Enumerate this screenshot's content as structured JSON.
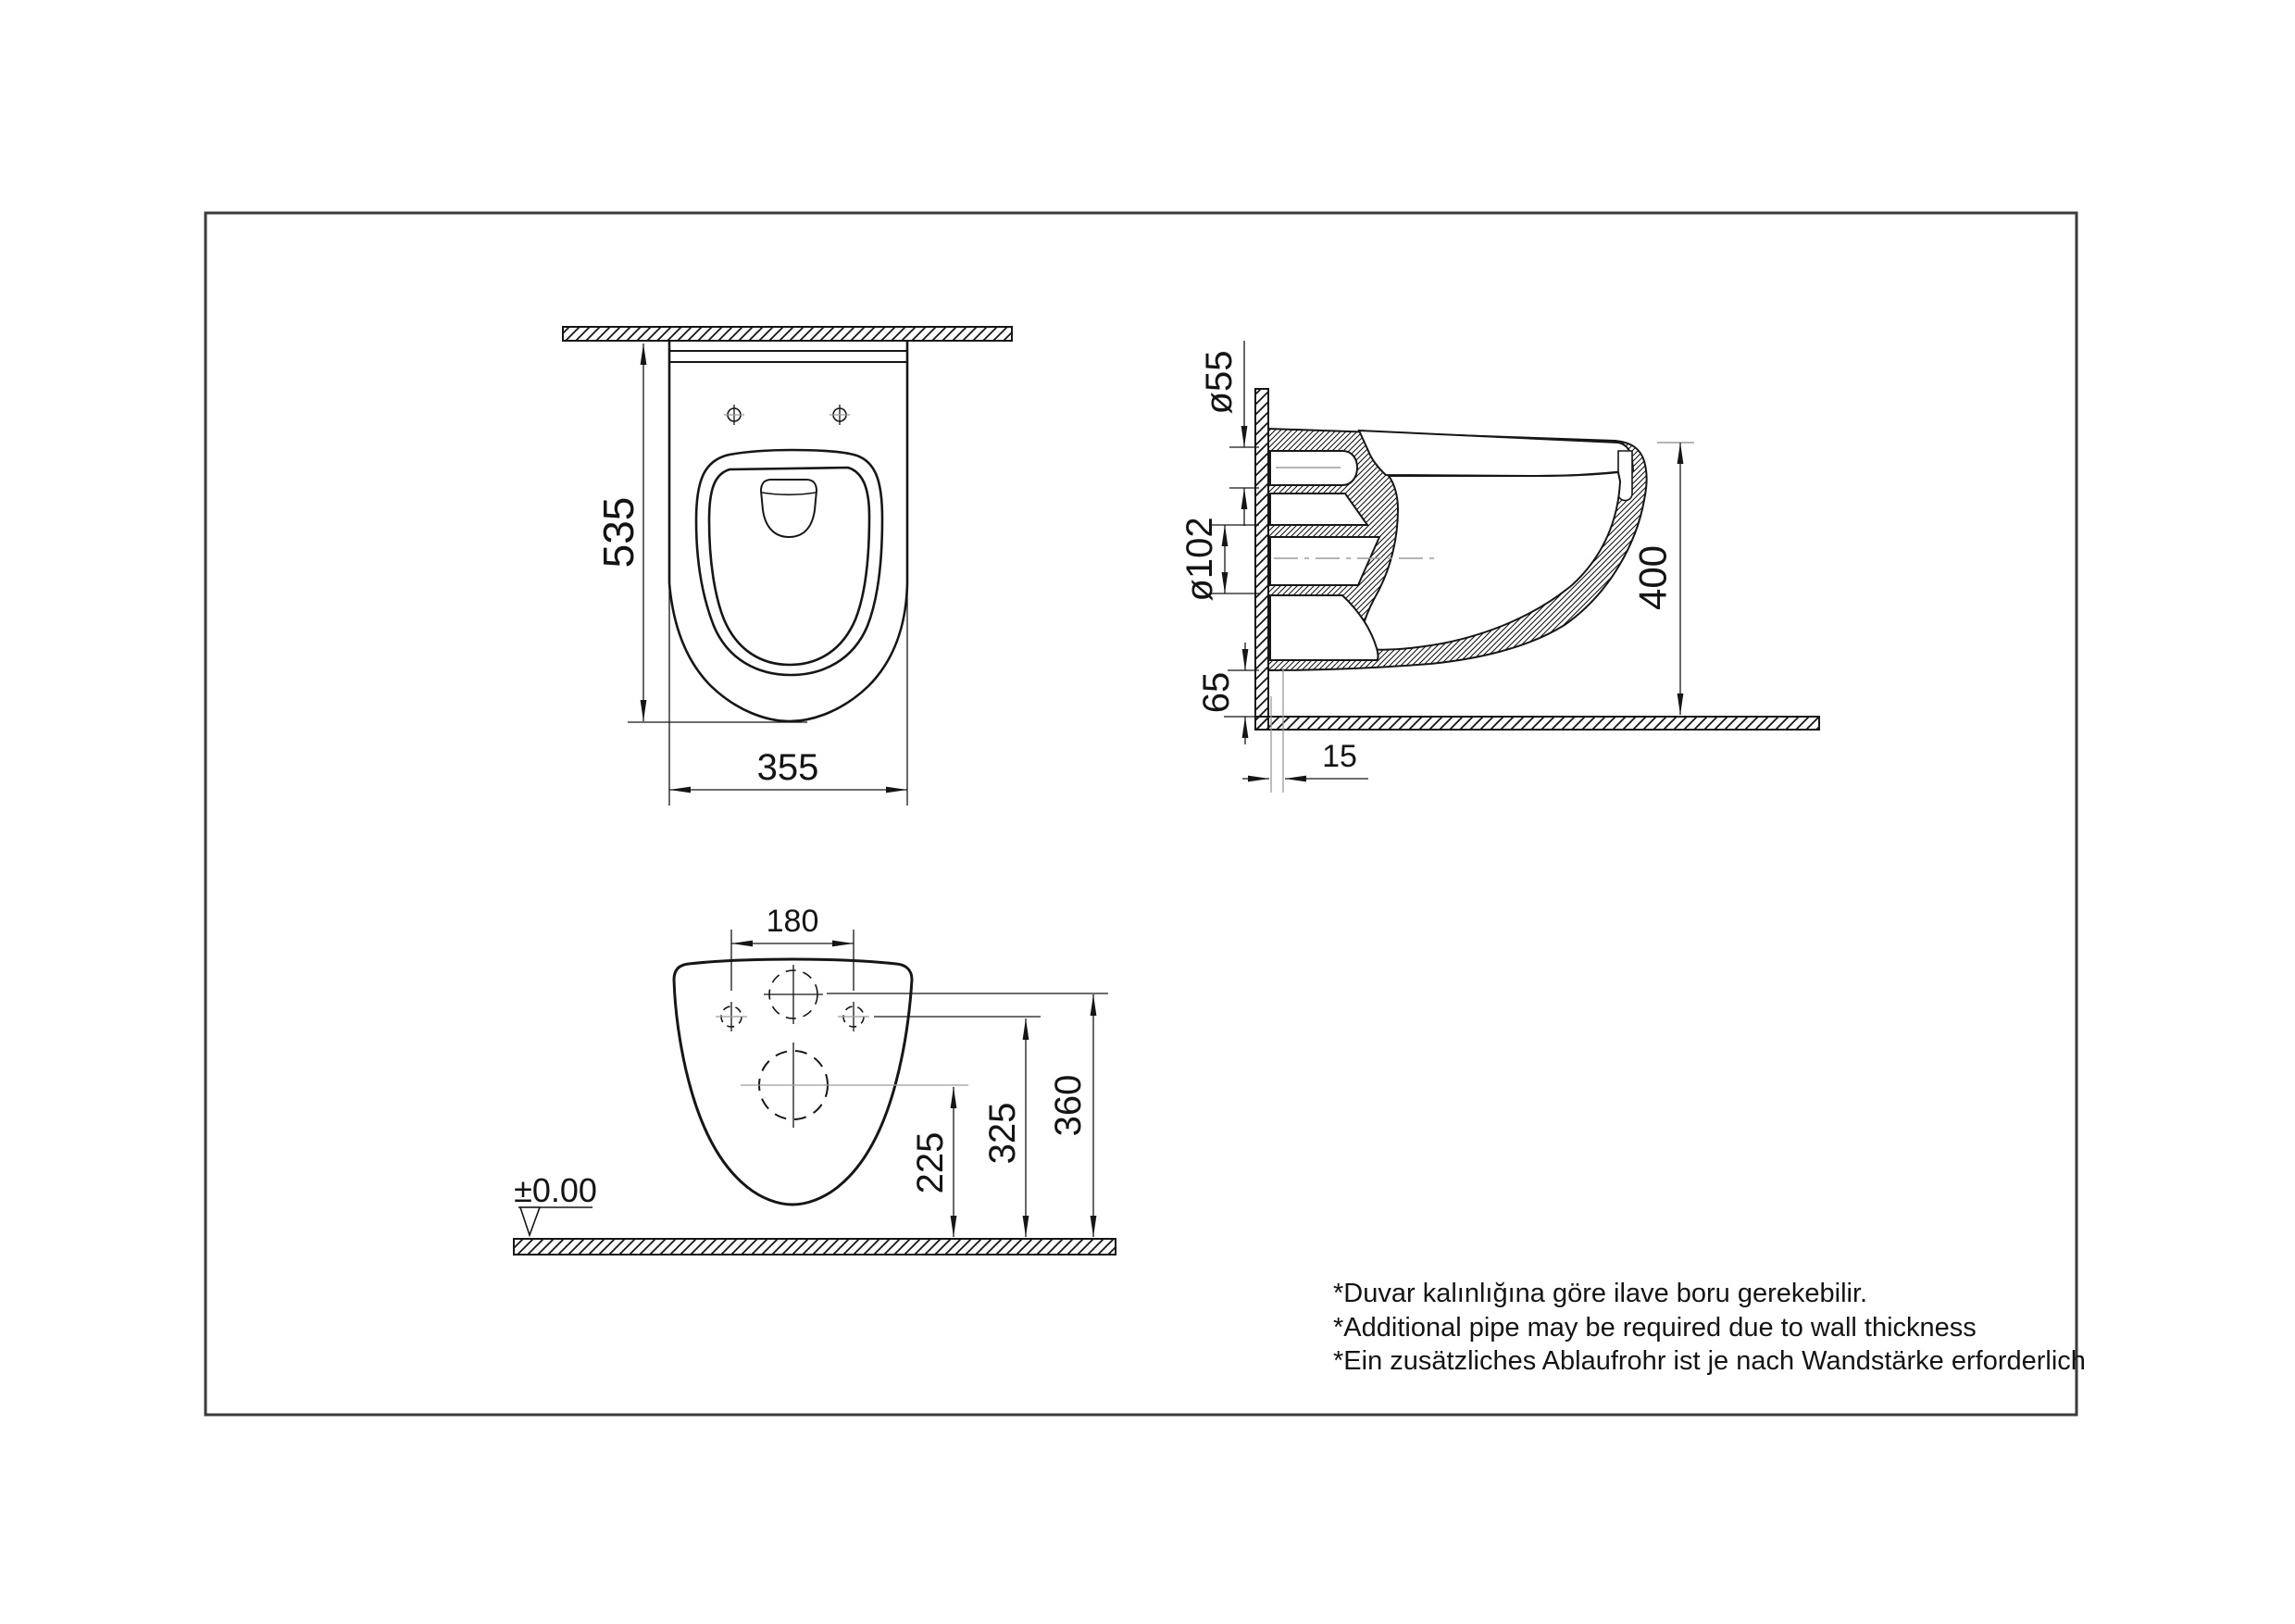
{
  "sheet": {
    "background": "#ffffff",
    "border_color": "#3b3b3b",
    "line_color": "#161616",
    "centerline_color": "#9c9c9c"
  },
  "front_view": {
    "height": "535",
    "width": "355"
  },
  "side_view": {
    "inlet_diameter": "ø55",
    "outlet_diameter": "ø102",
    "floor_clearance": "65",
    "rim_height": "400",
    "wall_thickness": "15"
  },
  "back_view": {
    "bolt_spacing": "180",
    "outlet_center_height": "225",
    "bolt_center_height": "325",
    "inlet_center_height": "360",
    "floor_datum": "±0.00"
  },
  "footnotes": [
    "*Duvar kalınlığına göre ilave boru gerekebilir.",
    "*Additional pipe may be required due to wall thickness",
    "*Ein zusätzliches Ablaufrohr ist je nach Wandstärke erforderlich"
  ]
}
